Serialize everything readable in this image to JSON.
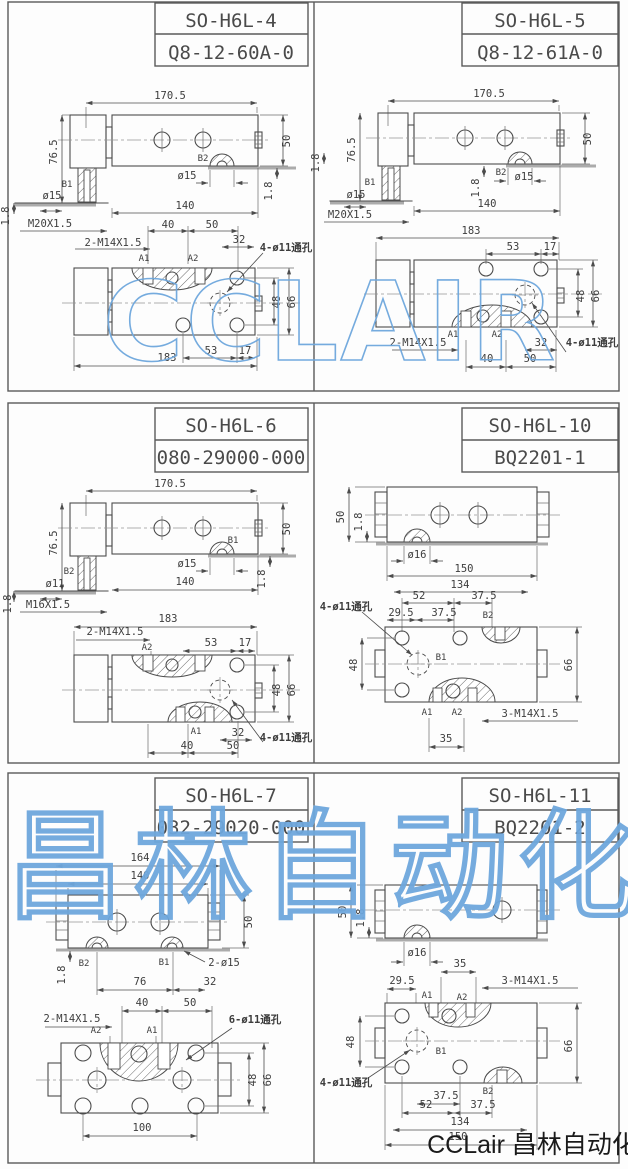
{
  "page": {
    "watermark_row1": "CCLAIR",
    "watermark_row3": "昌林自动化",
    "watermark_color": "#6ea7dd",
    "footer_brand": "CCLair 昌林自动化"
  },
  "panels": [
    {
      "model": "SO-H6L-4",
      "code": "Q8-12-60A-0",
      "labels": [
        {
          "t": "170.5",
          "x": 170,
          "y": 99
        },
        {
          "t": "76.5",
          "x": 57,
          "y": 152,
          "r": -90
        },
        {
          "t": "50",
          "x": 290,
          "y": 141,
          "r": -90
        },
        {
          "t": "B2",
          "x": 203,
          "y": 161,
          "k": "p"
        },
        {
          "t": "ø15",
          "x": 187,
          "y": 179
        },
        {
          "t": "1.8",
          "x": 272,
          "y": 191,
          "r": -90
        },
        {
          "t": "B1",
          "x": 67,
          "y": 187,
          "k": "p"
        },
        {
          "t": "ø15",
          "x": 52,
          "y": 199
        },
        {
          "t": "1.8",
          "x": 9,
          "y": 216,
          "r": -90
        },
        {
          "t": "M20X1.5",
          "x": 50,
          "y": 227
        },
        {
          "t": "140",
          "x": 185,
          "y": 209
        },
        {
          "t": "40",
          "x": 168,
          "y": 228
        },
        {
          "t": "50",
          "x": 212,
          "y": 228
        },
        {
          "t": "2-M14X1.5",
          "x": 113,
          "y": 246
        },
        {
          "t": "32",
          "x": 239,
          "y": 243
        },
        {
          "t": "4-ø11通孔",
          "x": 286,
          "y": 251,
          "k": "n"
        },
        {
          "t": "A1",
          "x": 144,
          "y": 261,
          "k": "p"
        },
        {
          "t": "A2",
          "x": 193,
          "y": 261,
          "k": "p"
        },
        {
          "t": "48",
          "x": 280,
          "y": 302,
          "r": -90
        },
        {
          "t": "66",
          "x": 295,
          "y": 302,
          "r": -90
        },
        {
          "t": "53",
          "x": 211,
          "y": 354
        },
        {
          "t": "17",
          "x": 245,
          "y": 354
        },
        {
          "t": "183",
          "x": 167,
          "y": 361
        }
      ]
    },
    {
      "model": "SO-H6L-5",
      "code": "Q8-12-61A-0",
      "labels": [
        {
          "t": "170.5",
          "x": 489,
          "y": 97
        },
        {
          "t": "76.5",
          "x": 355,
          "y": 150,
          "r": -90
        },
        {
          "t": "50",
          "x": 591,
          "y": 139,
          "r": -90
        },
        {
          "t": "1.8",
          "x": 479,
          "y": 188,
          "r": -90
        },
        {
          "t": "B2",
          "x": 501,
          "y": 175,
          "k": "p"
        },
        {
          "t": "ø15",
          "x": 524,
          "y": 180
        },
        {
          "t": "B1",
          "x": 370,
          "y": 185,
          "k": "p"
        },
        {
          "t": "ø15",
          "x": 356,
          "y": 198
        },
        {
          "t": "1.8",
          "x": 319,
          "y": 163,
          "r": -90
        },
        {
          "t": "M20X1.5",
          "x": 350,
          "y": 218
        },
        {
          "t": "140",
          "x": 487,
          "y": 207
        },
        {
          "t": "183",
          "x": 471,
          "y": 234
        },
        {
          "t": "53",
          "x": 513,
          "y": 250
        },
        {
          "t": "17",
          "x": 550,
          "y": 250
        },
        {
          "t": "48",
          "x": 584,
          "y": 296,
          "r": -90
        },
        {
          "t": "66",
          "x": 599,
          "y": 296,
          "r": -90
        },
        {
          "t": "2-M14X1.5",
          "x": 418,
          "y": 346
        },
        {
          "t": "A1",
          "x": 453,
          "y": 337,
          "k": "p"
        },
        {
          "t": "A2",
          "x": 497,
          "y": 337,
          "k": "p"
        },
        {
          "t": "32",
          "x": 541,
          "y": 346
        },
        {
          "t": "4-ø11通孔",
          "x": 592,
          "y": 346,
          "k": "n"
        },
        {
          "t": "40",
          "x": 487,
          "y": 362
        },
        {
          "t": "50",
          "x": 530,
          "y": 362
        }
      ]
    },
    {
      "model": "SO-H6L-6",
      "code": "080-29000-000",
      "labels": [
        {
          "t": "170.5",
          "x": 170,
          "y": 487
        },
        {
          "t": "76.5",
          "x": 57,
          "y": 543,
          "r": -90
        },
        {
          "t": "50",
          "x": 290,
          "y": 529,
          "r": -90
        },
        {
          "t": "B1",
          "x": 233,
          "y": 543,
          "k": "p"
        },
        {
          "t": "ø15",
          "x": 187,
          "y": 567
        },
        {
          "t": "1.8",
          "x": 265,
          "y": 579,
          "r": -90
        },
        {
          "t": "B2",
          "x": 69,
          "y": 574,
          "k": "p"
        },
        {
          "t": "ø11",
          "x": 55,
          "y": 587
        },
        {
          "t": "1.8",
          "x": 11,
          "y": 604,
          "r": -90
        },
        {
          "t": "M16X1.5",
          "x": 48,
          "y": 608
        },
        {
          "t": "140",
          "x": 185,
          "y": 585
        },
        {
          "t": "183",
          "x": 168,
          "y": 622
        },
        {
          "t": "2-M14X1.5",
          "x": 115,
          "y": 635
        },
        {
          "t": "A2",
          "x": 147,
          "y": 650,
          "k": "p"
        },
        {
          "t": "53",
          "x": 211,
          "y": 646
        },
        {
          "t": "17",
          "x": 245,
          "y": 646
        },
        {
          "t": "48",
          "x": 280,
          "y": 690,
          "r": -90
        },
        {
          "t": "66",
          "x": 295,
          "y": 690,
          "r": -90
        },
        {
          "t": "A1",
          "x": 196,
          "y": 734,
          "k": "p"
        },
        {
          "t": "32",
          "x": 238,
          "y": 736
        },
        {
          "t": "4-ø11通孔",
          "x": 286,
          "y": 741,
          "k": "n"
        },
        {
          "t": "40",
          "x": 187,
          "y": 749
        },
        {
          "t": "50",
          "x": 233,
          "y": 749
        }
      ]
    },
    {
      "model": "SO-H6L-10",
      "code": "BQ2201-1",
      "labels": [
        {
          "t": "50",
          "x": 344,
          "y": 517,
          "r": -90
        },
        {
          "t": "1.8",
          "x": 362,
          "y": 522,
          "r": -90
        },
        {
          "t": "ø16",
          "x": 417,
          "y": 558
        },
        {
          "t": "150",
          "x": 464,
          "y": 572
        },
        {
          "t": "134",
          "x": 460,
          "y": 588
        },
        {
          "t": "4-ø11通孔",
          "x": 346,
          "y": 610,
          "k": "n"
        },
        {
          "t": "52",
          "x": 419,
          "y": 599
        },
        {
          "t": "37.5",
          "x": 484,
          "y": 599
        },
        {
          "t": "29.5",
          "x": 401,
          "y": 616
        },
        {
          "t": "37.5",
          "x": 444,
          "y": 616
        },
        {
          "t": "B2",
          "x": 488,
          "y": 618,
          "k": "p"
        },
        {
          "t": "48",
          "x": 357,
          "y": 665,
          "r": -90
        },
        {
          "t": "B1",
          "x": 441,
          "y": 660,
          "k": "p"
        },
        {
          "t": "66",
          "x": 572,
          "y": 665,
          "r": -90
        },
        {
          "t": "A1",
          "x": 427,
          "y": 715,
          "k": "p"
        },
        {
          "t": "A2",
          "x": 457,
          "y": 715,
          "k": "p"
        },
        {
          "t": "3-M14X1.5",
          "x": 530,
          "y": 717
        },
        {
          "t": "35",
          "x": 446,
          "y": 742
        }
      ]
    },
    {
      "model": "SO-H6L-7",
      "code": "032-29020-000",
      "labels": [
        {
          "t": "164",
          "x": 140,
          "y": 861
        },
        {
          "t": "140",
          "x": 140,
          "y": 879
        },
        {
          "t": "50",
          "x": 252,
          "y": 922,
          "r": -90
        },
        {
          "t": "B2",
          "x": 84,
          "y": 966,
          "k": "p"
        },
        {
          "t": "B1",
          "x": 164,
          "y": 965,
          "k": "p"
        },
        {
          "t": "2-ø15",
          "x": 224,
          "y": 966
        },
        {
          "t": "1.8",
          "x": 65,
          "y": 975,
          "r": -90
        },
        {
          "t": "76",
          "x": 140,
          "y": 985
        },
        {
          "t": "32",
          "x": 210,
          "y": 985
        },
        {
          "t": "40",
          "x": 142,
          "y": 1006
        },
        {
          "t": "50",
          "x": 190,
          "y": 1006
        },
        {
          "t": "2-M14X1.5",
          "x": 72,
          "y": 1022
        },
        {
          "t": "6-ø11通孔",
          "x": 255,
          "y": 1023,
          "k": "n"
        },
        {
          "t": "A2",
          "x": 96,
          "y": 1033,
          "k": "p"
        },
        {
          "t": "A1",
          "x": 152,
          "y": 1033,
          "k": "p"
        },
        {
          "t": "48",
          "x": 256,
          "y": 1080,
          "r": -90
        },
        {
          "t": "66",
          "x": 271,
          "y": 1080,
          "r": -90
        },
        {
          "t": "100",
          "x": 142,
          "y": 1131
        }
      ]
    },
    {
      "model": "SO-H6L-11",
      "code": "BQ2201-2",
      "labels": [
        {
          "t": "50",
          "x": 346,
          "y": 912,
          "r": -90
        },
        {
          "t": "1.8",
          "x": 364,
          "y": 918,
          "r": -90
        },
        {
          "t": "ø16",
          "x": 417,
          "y": 956
        },
        {
          "t": "35",
          "x": 460,
          "y": 967
        },
        {
          "t": "29.5",
          "x": 402,
          "y": 984
        },
        {
          "t": "3-M14X1.5",
          "x": 530,
          "y": 984
        },
        {
          "t": "A1",
          "x": 427,
          "y": 998,
          "k": "p"
        },
        {
          "t": "A2",
          "x": 462,
          "y": 1000,
          "k": "p"
        },
        {
          "t": "48",
          "x": 354,
          "y": 1042,
          "r": -90
        },
        {
          "t": "B1",
          "x": 441,
          "y": 1054,
          "k": "p"
        },
        {
          "t": "66",
          "x": 572,
          "y": 1046,
          "r": -90
        },
        {
          "t": "4-ø11通孔",
          "x": 346,
          "y": 1086,
          "k": "n"
        },
        {
          "t": "37.5",
          "x": 446,
          "y": 1099
        },
        {
          "t": "B2",
          "x": 488,
          "y": 1094,
          "k": "p"
        },
        {
          "t": "52",
          "x": 426,
          "y": 1108
        },
        {
          "t": "37.5",
          "x": 483,
          "y": 1108
        },
        {
          "t": "134",
          "x": 460,
          "y": 1125
        },
        {
          "t": "150",
          "x": 458,
          "y": 1140
        }
      ]
    }
  ]
}
